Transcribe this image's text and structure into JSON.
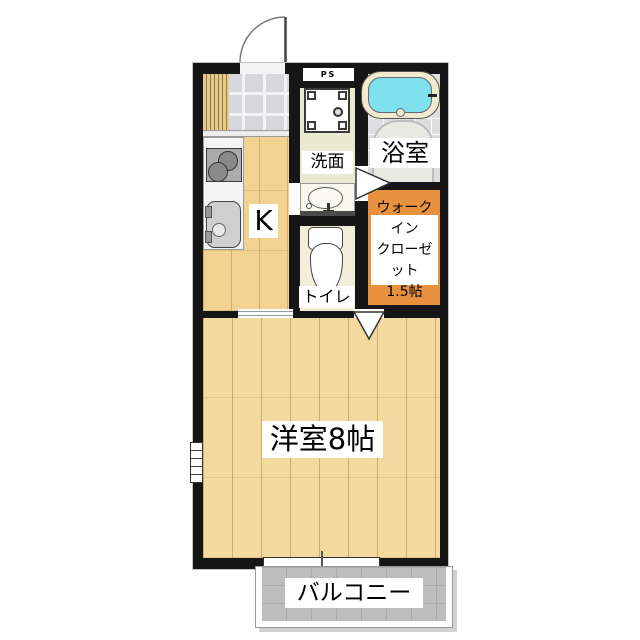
{
  "floorplan": {
    "kind": "japanese-apartment-floor-plan",
    "rooms": {
      "pipe_space": {
        "label": "PS"
      },
      "kitchen": {
        "label": "K"
      },
      "washroom": {
        "label": "洗面"
      },
      "bathroom": {
        "label": "浴室"
      },
      "toilet": {
        "label": "トイレ"
      },
      "walk_in_closet": {
        "label_lines": [
          "ウォークイン",
          "クローゼット",
          "1.5帖"
        ]
      },
      "main_room": {
        "label": "洋室8帖"
      },
      "balcony": {
        "label": "バルコニー"
      }
    },
    "colors": {
      "wall": "#161616",
      "room_wood_floor": "#F3DA9E",
      "kitchen_wood_floor": "#F1D291",
      "closet_orange": "#E8913E",
      "bathtub_cyan": "#7FE1ED",
      "bathtub_rim": "#F1EACB",
      "balcony_gray": "#BDBDBD",
      "entrance_tile_gray": "#D6D6DB",
      "washroom_floor": "#EAEAD3",
      "toilet_floor": "#F1EFDA",
      "bathroom_floor": "#DEDEE0"
    }
  }
}
